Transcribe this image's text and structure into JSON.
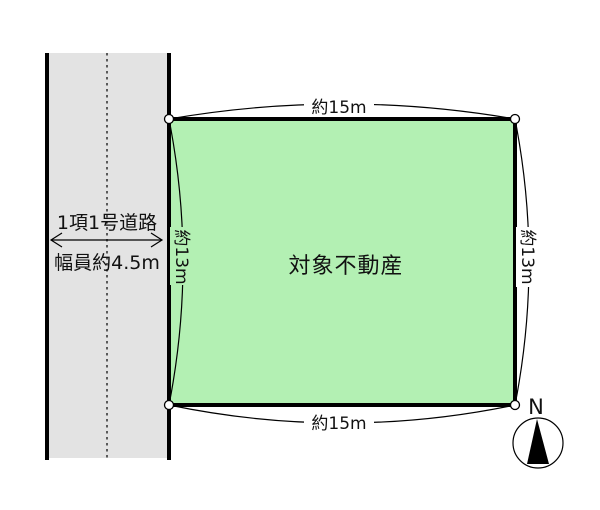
{
  "colors": {
    "background": "#ffffff",
    "parcel_fill": "#b3f0b3",
    "road_fill": "#e3e3e3",
    "line": "#000000"
  },
  "road": {
    "type_label": "1項1号道路",
    "width_label": "幅員約4.5m"
  },
  "parcel": {
    "label": "対象不動産",
    "dimensions": {
      "top": "約15m",
      "bottom": "約15m",
      "left": "約13m",
      "right": "約13m"
    }
  },
  "compass": {
    "north_label": "N"
  }
}
